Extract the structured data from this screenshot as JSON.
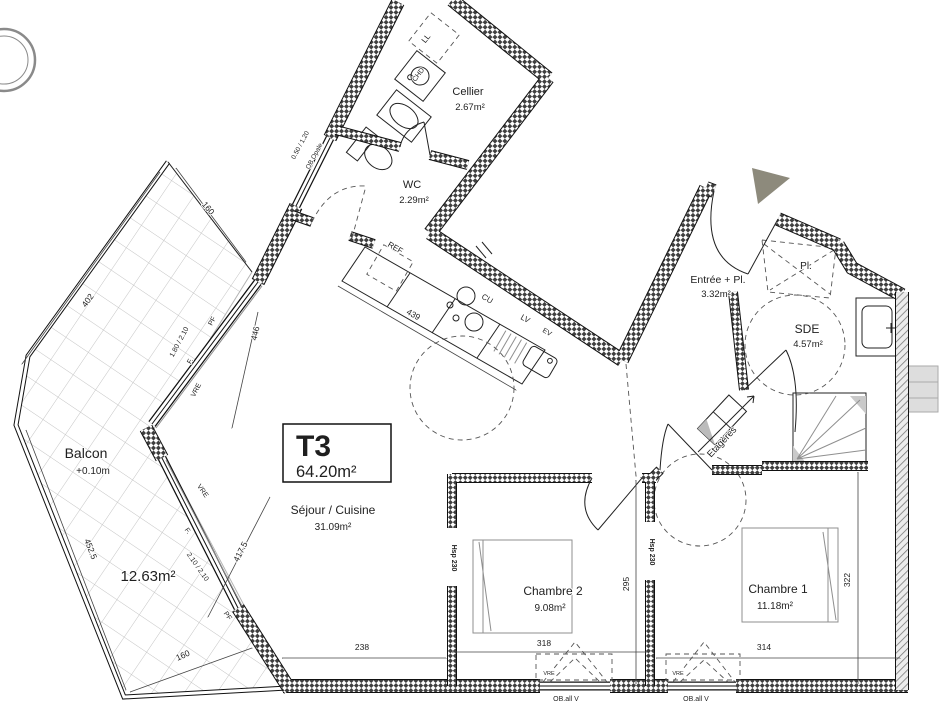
{
  "colors": {
    "entrance_marker": "#8d8a7c",
    "plan_line": "#1c1c1c",
    "tile_line": "#c4c4c4"
  },
  "unit_box": {
    "type": "T3",
    "area": "64.20m²"
  },
  "rooms": [
    {
      "id": "sejour-name",
      "text": "Séjour / Cuisine",
      "x": 333,
      "y": 514,
      "size": 12
    },
    {
      "id": "sejour-area",
      "text": "31.09m²",
      "x": 333,
      "y": 530,
      "size": 10
    },
    {
      "id": "balcon-name",
      "text": "Balcon",
      "x": 86,
      "y": 458,
      "size": 14
    },
    {
      "id": "balcon-level",
      "text": "+0.10m",
      "x": 93,
      "y": 474,
      "size": 10
    },
    {
      "id": "balcon-area",
      "text": "12.63m²",
      "x": 148,
      "y": 581,
      "size": 15
    },
    {
      "id": "cellier-name",
      "text": "Cellier",
      "x": 468,
      "y": 95,
      "size": 11
    },
    {
      "id": "cellier-area",
      "text": "2.67m²",
      "x": 470,
      "y": 110,
      "size": 9.5
    },
    {
      "id": "wc-name",
      "text": "WC",
      "x": 412,
      "y": 188,
      "size": 11
    },
    {
      "id": "wc-area",
      "text": "2.29m²",
      "x": 414,
      "y": 203,
      "size": 9.5
    },
    {
      "id": "entree-name",
      "text": "Entrée + Pl.",
      "x": 718,
      "y": 283,
      "size": 10.5
    },
    {
      "id": "entree-area",
      "text": "3.32m²",
      "x": 716,
      "y": 297,
      "size": 9.5
    },
    {
      "id": "placard",
      "text": "Pl.",
      "x": 806,
      "y": 269,
      "size": 10
    },
    {
      "id": "sde-name",
      "text": "SDE",
      "x": 807,
      "y": 333,
      "size": 12
    },
    {
      "id": "sde-area",
      "text": "4.57m²",
      "x": 808,
      "y": 347,
      "size": 9.5
    },
    {
      "id": "chambre2-name",
      "text": "Chambre 2",
      "x": 553,
      "y": 595,
      "size": 12
    },
    {
      "id": "chambre2-area",
      "text": "9.08m²",
      "x": 550,
      "y": 611,
      "size": 10
    },
    {
      "id": "chambre1-name",
      "text": "Chambre 1",
      "x": 778,
      "y": 593,
      "size": 12
    },
    {
      "id": "chambre1-area",
      "text": "11.18m²",
      "x": 775,
      "y": 609,
      "size": 10
    },
    {
      "id": "etageres",
      "text": "Etagères",
      "x": 724,
      "y": 444,
      "size": 9.5,
      "rot": -47
    }
  ],
  "fixtures": [
    {
      "id": "ref",
      "text": "REF",
      "x": 394,
      "y": 250,
      "size": 8,
      "rot": 30
    },
    {
      "id": "cu",
      "text": "CU",
      "x": 486,
      "y": 301,
      "size": 8,
      "rot": 30
    },
    {
      "id": "lv",
      "text": "LV",
      "x": 524,
      "y": 321,
      "size": 8,
      "rot": 30
    },
    {
      "id": "ev",
      "text": "EV",
      "x": 546,
      "y": 334,
      "size": 7,
      "rot": 30
    },
    {
      "id": "ll",
      "text": "LL",
      "x": 428,
      "y": 40,
      "size": 8,
      "rot": -52
    },
    {
      "id": "chd",
      "text": "CHD",
      "x": 420,
      "y": 76,
      "size": 7,
      "rot": -52
    },
    {
      "id": "hsp-1",
      "text": "Hsp 230",
      "x": 452,
      "y": 558,
      "size": 7,
      "rot": 90,
      "bold": true
    },
    {
      "id": "hsp-2",
      "text": "Hsp 230",
      "x": 650,
      "y": 552,
      "size": 7,
      "rot": 90,
      "bold": true
    }
  ],
  "windows": [
    {
      "id": "w1-f",
      "text": "F.",
      "x": 192,
      "y": 362,
      "size": 7,
      "rot": -62
    },
    {
      "id": "w1-dim",
      "text": "1.80 / 2.10",
      "x": 181,
      "y": 343,
      "size": 7,
      "rot": -62
    },
    {
      "id": "w1-pf",
      "text": "PF",
      "x": 214,
      "y": 322,
      "size": 7,
      "rot": -62
    },
    {
      "id": "w1-vre",
      "text": "VRE",
      "x": 198,
      "y": 391,
      "size": 7,
      "rot": -62
    },
    {
      "id": "w2-f",
      "text": "F.",
      "x": 186,
      "y": 532,
      "size": 7,
      "rot": 55
    },
    {
      "id": "w2-dim",
      "text": "2.10 / 2.10",
      "x": 196,
      "y": 568,
      "size": 7,
      "rot": 55
    },
    {
      "id": "w2-pf",
      "text": "PF",
      "x": 226,
      "y": 617,
      "size": 7,
      "rot": 55
    },
    {
      "id": "w2-vre",
      "text": "VRE",
      "x": 201,
      "y": 492,
      "size": 7,
      "rot": 55
    },
    {
      "id": "wc-win-dim",
      "text": "0.50 / 1.20",
      "x": 302,
      "y": 146,
      "size": 6.5,
      "rot": -62
    },
    {
      "id": "wc-win-type",
      "text": "OB Opale",
      "x": 316,
      "y": 157,
      "size": 6.5,
      "rot": -62
    },
    {
      "id": "bw1",
      "text": "OB.all V",
      "x": 566,
      "y": 701,
      "size": 7
    },
    {
      "id": "bw2",
      "text": "OB.all V",
      "x": 696,
      "y": 701,
      "size": 7
    },
    {
      "id": "bw1-vre",
      "text": "VRE",
      "x": 549,
      "y": 675,
      "size": 5.5
    },
    {
      "id": "bw2-vre",
      "text": "VRE",
      "x": 678,
      "y": 675,
      "size": 5.5
    }
  ],
  "dimensions": [
    {
      "id": "d238",
      "text": "238",
      "x": 362,
      "y": 650,
      "size": 8.5
    },
    {
      "id": "d318",
      "text": "318",
      "x": 544,
      "y": 646,
      "size": 8.5
    },
    {
      "id": "d314",
      "text": "314",
      "x": 764,
      "y": 650,
      "size": 8.5
    },
    {
      "id": "d295",
      "text": "295",
      "x": 629,
      "y": 584,
      "size": 8.5,
      "rot": -90
    },
    {
      "id": "d322",
      "text": "322",
      "x": 850,
      "y": 580,
      "size": 8.5,
      "rot": -90
    },
    {
      "id": "d439",
      "text": "439",
      "x": 412,
      "y": 317,
      "size": 8.5,
      "rot": 30
    },
    {
      "id": "d446",
      "text": "446",
      "x": 258,
      "y": 334,
      "size": 8.5,
      "rot": -77
    },
    {
      "id": "d417",
      "text": "417.5",
      "x": 243,
      "y": 553,
      "size": 8.5,
      "rot": -63
    },
    {
      "id": "d402",
      "text": "402",
      "x": 90,
      "y": 302,
      "size": 8.5,
      "rot": -54
    },
    {
      "id": "d452",
      "text": "452.5",
      "x": 88,
      "y": 550,
      "size": 8.5,
      "rot": 69
    },
    {
      "id": "d160t",
      "text": "160",
      "x": 206,
      "y": 210,
      "size": 8.5,
      "rot": 50
    },
    {
      "id": "d160b",
      "text": "160",
      "x": 184,
      "y": 658,
      "size": 8.5,
      "rot": -24
    }
  ]
}
